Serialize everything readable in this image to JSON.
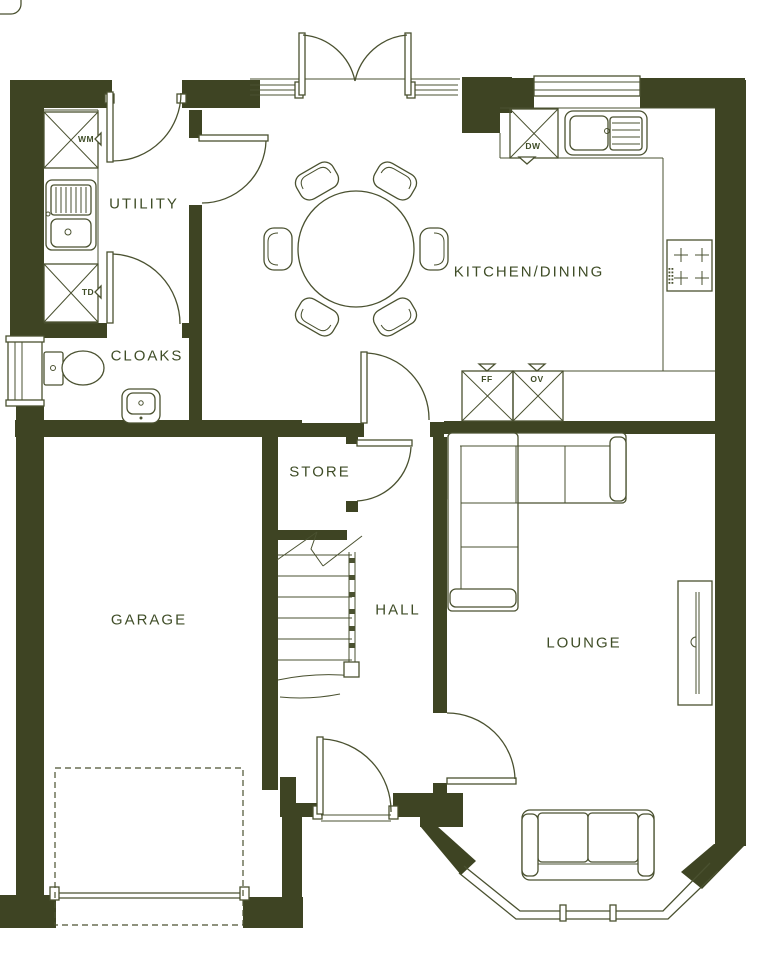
{
  "colors": {
    "wall": "#3e4423",
    "line": "#4a5130",
    "label": "#3f4d27",
    "bg": "#ffffff"
  },
  "rooms": {
    "utility": {
      "label": "UTILITY"
    },
    "cloaks": {
      "label": "CLOAKS"
    },
    "kitchen_dining": {
      "label": "KITCHEN/DINING"
    },
    "store": {
      "label": "STORE"
    },
    "hall": {
      "label": "HALL"
    },
    "garage": {
      "label": "GARAGE"
    },
    "lounge": {
      "label": "LOUNGE"
    }
  },
  "appliances": {
    "washing_machine": {
      "label": "WM"
    },
    "tumble_dryer": {
      "label": "TD"
    },
    "dishwasher": {
      "label": "DW"
    },
    "fridge_freezer": {
      "label": "FF"
    },
    "oven": {
      "label": "OV"
    }
  }
}
